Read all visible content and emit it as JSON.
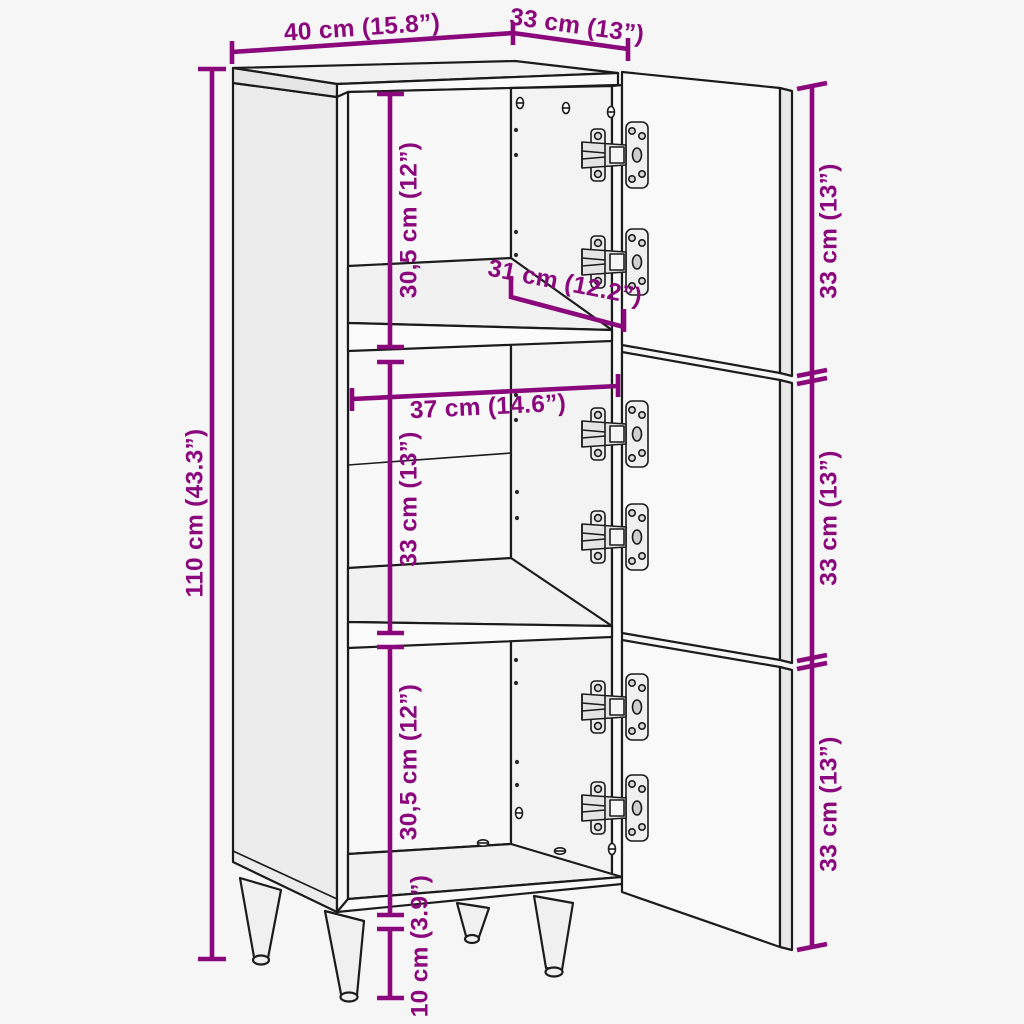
{
  "diagram": {
    "kind": "furniture-dimension-diagram",
    "subject": "highboard cabinet with 3 open doors, 2 shelves, 6 hinges and 4 tapered legs",
    "colors": {
      "annotation": "#8a077c",
      "outline": "#1c1c1c",
      "background": "#f6f6f6"
    },
    "labels": {
      "width_top": "40 cm (15.8”)",
      "depth_top": "33 cm (13”)",
      "height_left": "110 cm (43.3”)",
      "compartment_top": "30,5 cm (12”)",
      "shelf_depth": "31 cm (12.2”)",
      "inner_width": "37 cm (14.6”)",
      "compartment_middle": "33 cm (13”)",
      "compartment_bottom": "30,5 cm (12”)",
      "leg_height": "10 cm (3.9”)",
      "door_top": "33 cm (13”)",
      "door_middle": "33 cm (13”)",
      "door_bottom": "33 cm (13”)"
    }
  }
}
